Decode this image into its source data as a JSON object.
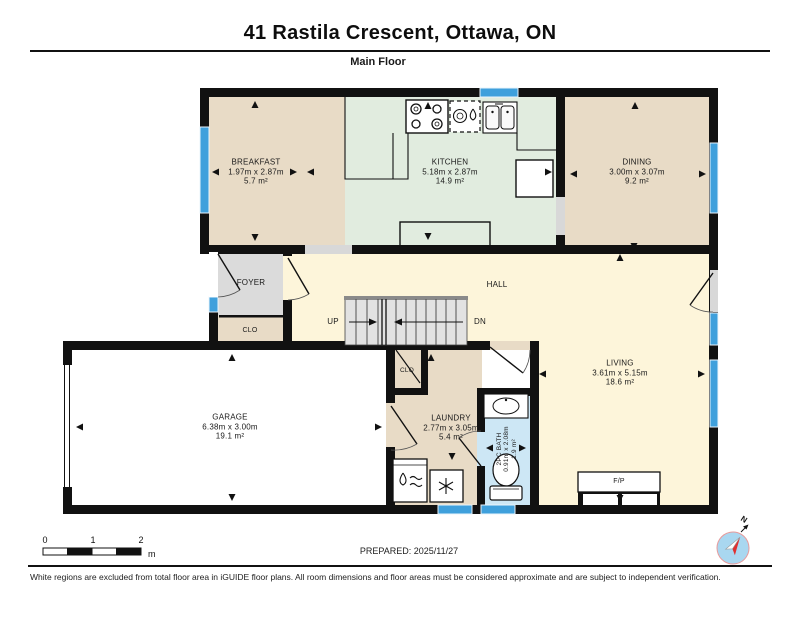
{
  "header": {
    "title": "41 Rastila Crescent, Ottawa, ON",
    "floor_label": "Main Floor"
  },
  "rooms": {
    "breakfast": {
      "name": "BREAKFAST",
      "dims": "1.97m x 2.87m",
      "area": "5.7 m²"
    },
    "kitchen": {
      "name": "KITCHEN",
      "dims": "5.18m x 2.87m",
      "area": "14.9 m²"
    },
    "dining": {
      "name": "DINING",
      "dims": "3.00m x 3.07m",
      "area": "9.2 m²"
    },
    "foyer": {
      "name": "FOYER"
    },
    "foyer_closet": {
      "name": "CLO"
    },
    "hall": {
      "name": "HALL"
    },
    "stairs": {
      "up": "UP",
      "down": "DN"
    },
    "living": {
      "name": "LIVING",
      "dims": "3.61m x 5.15m",
      "area": "18.6 m²"
    },
    "garage": {
      "name": "GARAGE",
      "dims": "6.38m x 3.00m",
      "area": "19.1 m²"
    },
    "laundry": {
      "name": "LAUNDRY",
      "dims": "2.77m x 3.05m",
      "area": "5.4 m²"
    },
    "laundry_closet": {
      "name": "CLO"
    },
    "bath": {
      "name": "2PC BATH",
      "dims": "0.91m x 2.08m",
      "area": "1.9 m²"
    },
    "fireplace": {
      "name": "F/P"
    }
  },
  "scale_bar": {
    "tick0": "0",
    "tick1": "1",
    "tick2": "2",
    "unit": "m"
  },
  "prepared": "PREPARED: 2025/11/27",
  "compass": {
    "north_label": "N"
  },
  "footer": "White regions are excluded from total floor area in iGUIDE floor plans. All room dimensions and floor areas must be considered approximate and are subject to independent verification.",
  "fixtures": [
    "stove-icon",
    "dishwasher-icon",
    "double-sink-icon",
    "refrigerator-icon",
    "kitchen-island",
    "fireplace",
    "stairs-up",
    "stairs-down",
    "washer-icon",
    "dryer-icon",
    "bathroom-sink-icon",
    "toilet-icon",
    "garage-door",
    "window",
    "door-swing",
    "compass-icon"
  ],
  "colors": {
    "wall": "#111111",
    "window_blue": "#3fa0dc",
    "room_tan": "#e8dbc6",
    "room_green": "#e1ecdf",
    "room_cream": "#fdf5da",
    "room_gray": "#dbdbdb",
    "bath_blue": "#cde7f5",
    "garage_white": "#ffffff",
    "opening_gray": "#d8d8d8",
    "compass_blue": "#a9d7f0",
    "compass_red": "#e03030"
  }
}
